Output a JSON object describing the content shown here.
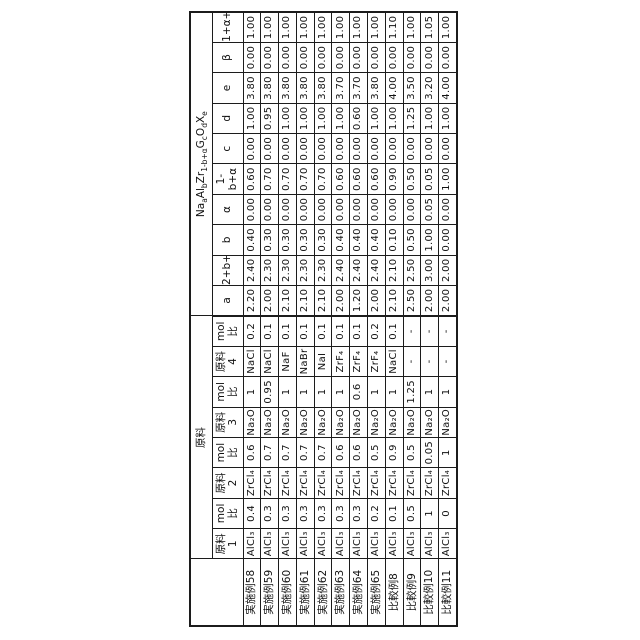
{
  "colors": {
    "background": "#ffffff",
    "border": "#1c1c1c",
    "text": "#111111"
  },
  "table": {
    "corner_label": "",
    "group_materials": "原料",
    "group_formula": "Na_a|Al_b|Zr_1-b+α|G_c|O_d|X_e",
    "columns": [
      "原料\n1",
      "mol比",
      "原料\n2",
      "mol比",
      "原料\n3",
      "mol比",
      "原料\n4",
      "mol比",
      "a",
      "2+b+β",
      "b",
      "α",
      "1-b+α",
      "c",
      "d",
      "e",
      "β",
      "1+α+c"
    ],
    "rows": [
      {
        "label": "実施例58",
        "values": [
          "AlCl₃",
          "0.4",
          "ZrCl₄",
          "0.6",
          "Na₂O",
          "1",
          "NaCl",
          "0.2",
          "2.20",
          "2.40",
          "0.40",
          "0.00",
          "0.60",
          "0.00",
          "1.00",
          "3.80",
          "0.00",
          "1.00"
        ]
      },
      {
        "label": "実施例59",
        "values": [
          "AlCl₃",
          "0.3",
          "ZrCl₄",
          "0.7",
          "Na₂O",
          "0.95",
          "NaCl",
          "0.1",
          "2.00",
          "2.30",
          "0.30",
          "0.00",
          "0.70",
          "0.00",
          "0.95",
          "3.80",
          "0.00",
          "1.00"
        ]
      },
      {
        "label": "実施例60",
        "values": [
          "AlCl₃",
          "0.3",
          "ZrCl₄",
          "0.7",
          "Na₂O",
          "1",
          "NaF",
          "0.1",
          "2.10",
          "2.30",
          "0.30",
          "0.00",
          "0.70",
          "0.00",
          "1.00",
          "3.80",
          "0.00",
          "1.00"
        ]
      },
      {
        "label": "実施例61",
        "values": [
          "AlCl₃",
          "0.3",
          "ZrCl₄",
          "0.7",
          "Na₂O",
          "1",
          "NaBr",
          "0.1",
          "2.10",
          "2.30",
          "0.30",
          "0.00",
          "0.70",
          "0.00",
          "1.00",
          "3.80",
          "0.00",
          "1.00"
        ]
      },
      {
        "label": "実施例62",
        "values": [
          "AlCl₃",
          "0.3",
          "ZrCl₄",
          "0.7",
          "Na₂O",
          "1",
          "NaI",
          "0.1",
          "2.10",
          "2.30",
          "0.30",
          "0.00",
          "0.70",
          "0.00",
          "1.00",
          "3.80",
          "0.00",
          "1.00"
        ]
      },
      {
        "label": "実施例63",
        "values": [
          "AlCl₃",
          "0.3",
          "ZrCl₄",
          "0.6",
          "Na₂O",
          "1",
          "ZrF₄",
          "0.1",
          "2.00",
          "2.40",
          "0.40",
          "0.00",
          "0.60",
          "0.00",
          "1.00",
          "3.70",
          "0.00",
          "1.00"
        ]
      },
      {
        "label": "実施例64",
        "values": [
          "AlCl₃",
          "0.3",
          "ZrCl₄",
          "0.6",
          "Na₂O",
          "0.6",
          "ZrF₄",
          "0.1",
          "1.20",
          "2.40",
          "0.40",
          "0.00",
          "0.60",
          "0.00",
          "0.60",
          "3.70",
          "0.00",
          "1.00"
        ]
      },
      {
        "label": "実施例65",
        "values": [
          "AlCl₃",
          "0.2",
          "ZrCl₄",
          "0.5",
          "Na₂O",
          "1",
          "ZrF₄",
          "0.2",
          "2.00",
          "2.40",
          "0.40",
          "0.00",
          "0.60",
          "0.00",
          "1.00",
          "3.80",
          "0.00",
          "1.00"
        ]
      },
      {
        "label": "比較例8",
        "values": [
          "AlCl₃",
          "0.1",
          "ZrCl₄",
          "0.9",
          "Na₂O",
          "1",
          "NaCl",
          "0.1",
          "2.10",
          "2.10",
          "0.10",
          "0.00",
          "0.90",
          "0.00",
          "1.00",
          "4.00",
          "0.00",
          "1.10"
        ]
      },
      {
        "label": "比較例9",
        "values": [
          "AlCl₃",
          "0.5",
          "ZrCl₄",
          "0.5",
          "Na₂O",
          "1.25",
          "-",
          "-",
          "2.50",
          "2.50",
          "0.50",
          "0.00",
          "0.50",
          "0.00",
          "1.25",
          "3.50",
          "0.00",
          "1.00"
        ]
      },
      {
        "label": "比較例10",
        "values": [
          "AlCl₃",
          "1",
          "ZrCl₄",
          "0.05",
          "Na₂O",
          "1",
          "-",
          "-",
          "2.00",
          "3.00",
          "1.00",
          "0.05",
          "0.05",
          "0.00",
          "1.00",
          "3.20",
          "0.00",
          "1.05"
        ]
      },
      {
        "label": "比較例11",
        "values": [
          "AlCl₃",
          "0",
          "ZrCl₄",
          "1",
          "Na₂O",
          "1",
          "-",
          "-",
          "2.00",
          "2.00",
          "0.00",
          "0.00",
          "1.00",
          "0.00",
          "1.00",
          "4.00",
          "0.00",
          "1.00"
        ]
      }
    ]
  }
}
